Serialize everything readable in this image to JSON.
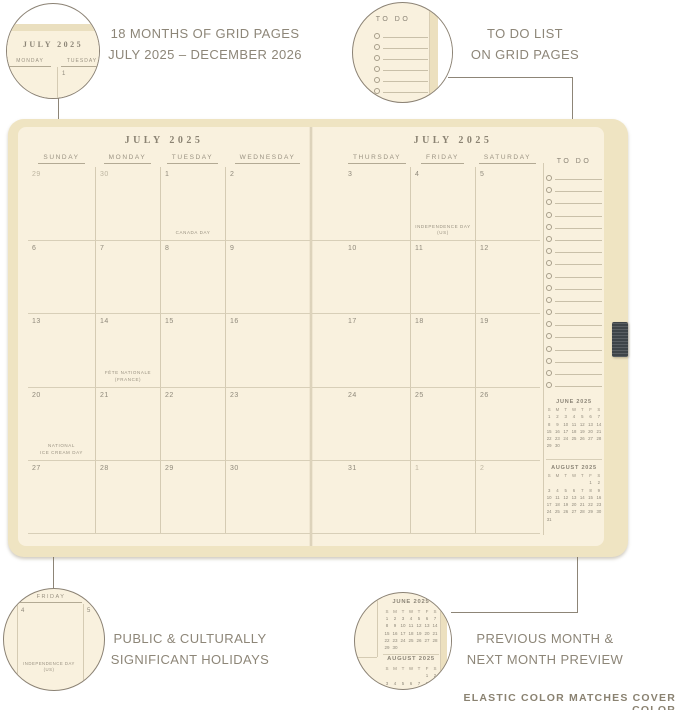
{
  "colors": {
    "page": "#f9f1de",
    "cover": "#efe4c2",
    "elastic": "#3e4448",
    "grid_line": "#d8cfb8",
    "ink": "#8f897b",
    "annotation_text": "#8d8678"
  },
  "annotations": {
    "top_left": {
      "line1": "18 MONTHS OF GRID PAGES",
      "line2": "JULY 2025 – DECEMBER 2026"
    },
    "top_right": {
      "line1": "TO DO LIST",
      "line2": "ON GRID PAGES"
    },
    "bottom_left": {
      "line1": "PUBLIC & CULTURALLY",
      "line2": "SIGNIFICANT HOLIDAYS"
    },
    "bottom_right": {
      "line1": "PREVIOUS MONTH &",
      "line2": "NEXT MONTH PREVIEW"
    },
    "footer": "ELASTIC COLOR MATCHES COVER COLOR"
  },
  "spread": {
    "left_page": {
      "title": "JULY 2025",
      "day_headers": [
        "SUNDAY",
        "MONDAY",
        "TUESDAY",
        "WEDNESDAY"
      ],
      "weeks": [
        [
          {
            "d": "29",
            "muted": true
          },
          {
            "d": "30",
            "muted": true
          },
          {
            "d": "1",
            "holiday": "CANADA DAY"
          },
          {
            "d": "2"
          }
        ],
        [
          {
            "d": "6"
          },
          {
            "d": "7"
          },
          {
            "d": "8"
          },
          {
            "d": "9"
          }
        ],
        [
          {
            "d": "13"
          },
          {
            "d": "14",
            "holiday": "FÊTE NATIONALE\n(FRANCE)"
          },
          {
            "d": "15"
          },
          {
            "d": "16"
          }
        ],
        [
          {
            "d": "20",
            "holiday": "NATIONAL\nICE CREAM DAY"
          },
          {
            "d": "21"
          },
          {
            "d": "22"
          },
          {
            "d": "23"
          }
        ],
        [
          {
            "d": "27"
          },
          {
            "d": "28"
          },
          {
            "d": "29"
          },
          {
            "d": "30"
          }
        ]
      ]
    },
    "right_page": {
      "title": "JULY 2025",
      "day_headers": [
        "THURSDAY",
        "FRIDAY",
        "SATURDAY"
      ],
      "weeks": [
        [
          {
            "d": "3"
          },
          {
            "d": "4",
            "holiday": "INDEPENDENCE DAY\n(US)"
          },
          {
            "d": "5"
          }
        ],
        [
          {
            "d": "10"
          },
          {
            "d": "11"
          },
          {
            "d": "12"
          }
        ],
        [
          {
            "d": "17"
          },
          {
            "d": "18"
          },
          {
            "d": "19"
          }
        ],
        [
          {
            "d": "24"
          },
          {
            "d": "25"
          },
          {
            "d": "26"
          }
        ],
        [
          {
            "d": "31"
          },
          {
            "d": "1",
            "muted": true
          },
          {
            "d": "2",
            "muted": true
          }
        ]
      ],
      "todo": {
        "title": "TO DO",
        "row_count": 18
      },
      "mini_calendars": [
        {
          "title": "JUNE 2025",
          "dow": [
            "S",
            "M",
            "T",
            "W",
            "T",
            "F",
            "S"
          ],
          "weeks": [
            [
              "1",
              "2",
              "3",
              "4",
              "5",
              "6",
              "7"
            ],
            [
              "8",
              "9",
              "10",
              "11",
              "12",
              "13",
              "14"
            ],
            [
              "15",
              "16",
              "17",
              "18",
              "19",
              "20",
              "21"
            ],
            [
              "22",
              "23",
              "24",
              "25",
              "26",
              "27",
              "28"
            ],
            [
              "29",
              "30",
              "",
              "",
              "",
              "",
              ""
            ]
          ]
        },
        {
          "title": "AUGUST 2025",
          "dow": [
            "S",
            "M",
            "T",
            "W",
            "T",
            "F",
            "S"
          ],
          "weeks": [
            [
              "",
              "",
              "",
              "",
              "",
              "1",
              "2"
            ],
            [
              "3",
              "4",
              "5",
              "6",
              "7",
              "8",
              "9"
            ],
            [
              "10",
              "11",
              "12",
              "13",
              "14",
              "15",
              "16"
            ],
            [
              "17",
              "18",
              "19",
              "20",
              "21",
              "22",
              "23"
            ],
            [
              "24",
              "25",
              "26",
              "27",
              "28",
              "29",
              "30"
            ],
            [
              "31",
              "",
              "",
              "",
              "",
              "",
              ""
            ]
          ]
        }
      ]
    }
  },
  "insets": {
    "top_left": {
      "title": "JULY 2025",
      "day_headers": [
        "MONDAY",
        "TUESDAY"
      ],
      "date": "1"
    },
    "top_right": {
      "title": "TO DO",
      "row_count": 7
    },
    "bottom_left": {
      "day_header": "FRIDAY",
      "dates": [
        "4",
        "5"
      ],
      "holiday": "INDEPENDENCE DAY\n(US)"
    }
  }
}
